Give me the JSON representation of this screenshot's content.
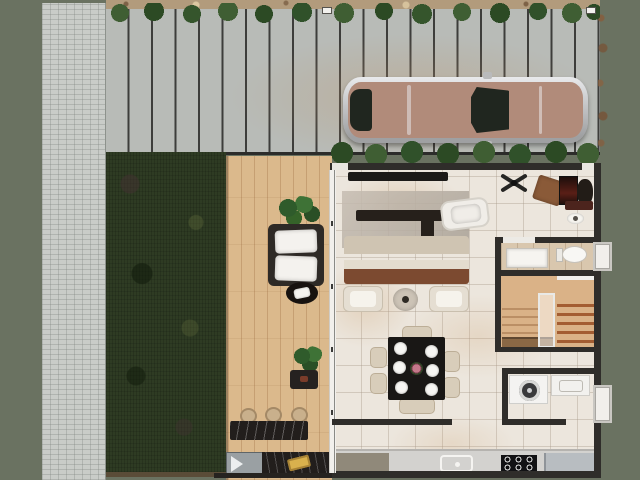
{
  "scene": {
    "type": "top-down 3D rendered residential floor plan",
    "areas": {
      "site": [
        "paver-walkway",
        "plank-driveway",
        "hedge-row-top",
        "hedge-row-inner",
        "lawn",
        "wood-deck"
      ],
      "house": [
        "living-room",
        "home-office-nook",
        "bathroom",
        "staircase",
        "laundry-room",
        "dining-area",
        "kitchen"
      ]
    },
    "inventory": {
      "driveway": [
        "parked-car",
        "gate-latch-left",
        "gate-latch-right"
      ],
      "deck": [
        "potted-plant",
        "lounge-chair",
        "oval-side-table",
        "potted-plant",
        "small-table",
        "bar-stool",
        "bar-stool",
        "bar-stool",
        "bar-counter",
        "grill",
        "outdoor-counter",
        "serving-tray"
      ],
      "living-room": [
        "wall-tv",
        "area-rug",
        "coffee-table",
        "chaise-lounge",
        "sofa",
        "throw-pillows",
        "armchair",
        "armchair",
        "round-side-table",
        "ceiling-fan"
      ],
      "office-nook": [
        "desk",
        "monitor",
        "desk-chair",
        "floor-mat",
        "decorative-dish"
      ],
      "bathroom": [
        "shower-tray",
        "toilet",
        "window"
      ],
      "staircase": [
        "wood-treads",
        "glass-railing"
      ],
      "laundry": [
        "washing-machine",
        "laundry-sink",
        "window"
      ],
      "dining": [
        "dining-table",
        "dinner-plates-x6",
        "floral-centerpiece",
        "dining-chairs-x6"
      ],
      "kitchen": [
        "gray-cabinet",
        "kitchen-sink",
        "cooktop-4-burner",
        "refrigerator",
        "half-wall"
      ]
    }
  },
  "colors": {
    "bg": "#6a7261",
    "walkway": "#c9ccc8",
    "driveway": "#b8bbb7",
    "plankJoint": "#3d3d3b",
    "mulch": "#b29b7c",
    "hedgeLight": "#3f5e33",
    "hedgeDark": "#2c4a24",
    "grass": "#2e3b23",
    "deck": "#dbb98c",
    "wall": "#2f2d2a",
    "floor": "#ece6dd",
    "bathFloor": "#d9c7ae",
    "stairWood": "#dab287",
    "stairTread": "#a35d32",
    "sofaBeige": "#cfc4b2",
    "pillowDark": "#45413a",
    "pillowCream": "#eae2d1",
    "sofaWood": "#7c4a30",
    "tableBlack": "#191715",
    "stool": "#c9b08c",
    "marble": "#221e1c",
    "cabinetGray": "#90897a",
    "cooktop": "#121214",
    "appliance": "#b8bdc1",
    "loungeFrame": "#2e2a26",
    "carSilver": "#cfd0d2",
    "carBody": "#b18b7a",
    "carGlass": "#20261f",
    "accentYellow": "#d9b14d",
    "flower": "#c4788a"
  }
}
